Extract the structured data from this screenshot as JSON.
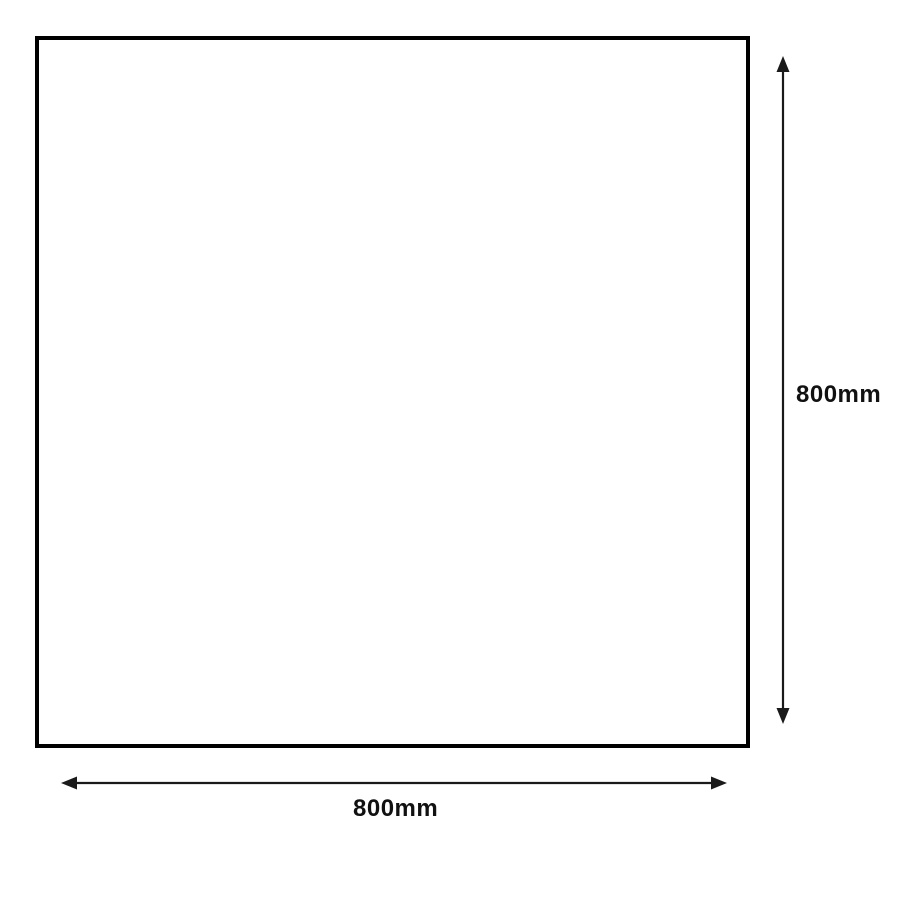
{
  "diagram": {
    "shape": "square",
    "width_label": "800mm",
    "height_label": "800mm",
    "stroke_color": "#1a1a1a",
    "square_border_color": "#000000",
    "background_color": "#ffffff"
  }
}
